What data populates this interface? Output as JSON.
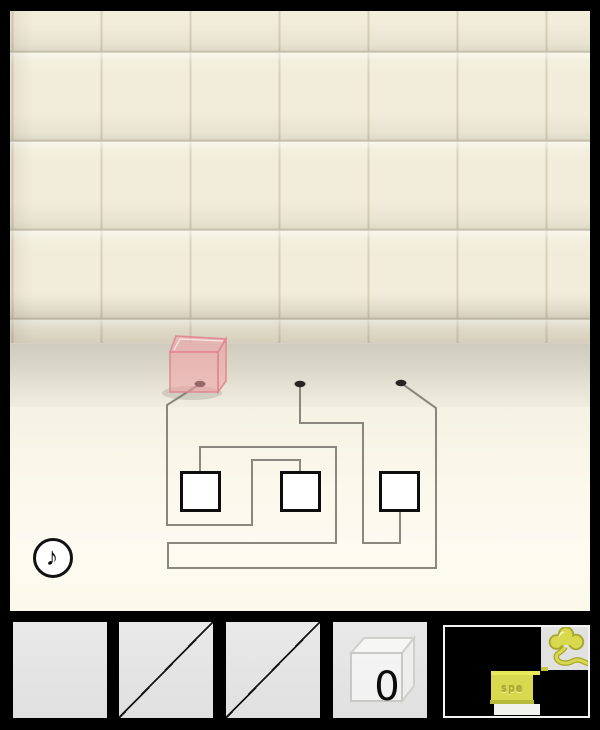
{
  "theme": {
    "tile": "#f2edda",
    "grout": "#d7d0b9",
    "ct-back": "#cfcbbd",
    "ct-front": "#f1eee1",
    "face1": "#f7f4e6",
    "face2": "#fdfbf1",
    "gold": "#d9d94f",
    "gold-bright": "#e9e95e",
    "gold-dark": "#b9b93c"
  },
  "scene": {
    "music_button": {
      "glyph": "♪"
    },
    "pink_cube": {
      "fill": "#f2a0a6",
      "edge": "#e2848f",
      "opacity": 0.55,
      "front": [
        [
          160,
          341
        ],
        [
          208,
          341
        ],
        [
          208,
          381
        ],
        [
          160,
          381
        ]
      ],
      "top": [
        [
          160,
          341
        ],
        [
          166,
          325
        ],
        [
          216,
          328
        ],
        [
          208,
          341
        ]
      ],
      "side": [
        [
          208,
          341
        ],
        [
          216,
          328
        ],
        [
          216,
          370
        ],
        [
          208,
          381
        ]
      ],
      "shadow": [
        182,
        382,
        30,
        7
      ]
    },
    "wire_puzzle": {
      "wire_color": "#8a877e",
      "dot_color": "#2a2420",
      "dots": [
        [
          190,
          373
        ],
        [
          290,
          373
        ],
        [
          391,
          372
        ]
      ],
      "boxes": [
        [
          170,
          460,
          41,
          41
        ],
        [
          270,
          460,
          41,
          41
        ],
        [
          369,
          460,
          41,
          41
        ]
      ],
      "paths": [
        [
          [
            190,
            373
          ],
          [
            157,
            394
          ],
          [
            157,
            514
          ],
          [
            242,
            514
          ],
          [
            242,
            449
          ],
          [
            290,
            449
          ],
          [
            290,
            462
          ]
        ],
        [
          [
            290,
            373
          ],
          [
            290,
            412
          ],
          [
            353,
            412
          ],
          [
            353,
            532
          ],
          [
            390,
            532
          ],
          [
            390,
            500
          ]
        ],
        [
          [
            391,
            372
          ],
          [
            426,
            397
          ],
          [
            426,
            557
          ],
          [
            158,
            557
          ],
          [
            158,
            532
          ],
          [
            326,
            532
          ],
          [
            326,
            436
          ],
          [
            190,
            436
          ],
          [
            190,
            462
          ]
        ]
      ]
    }
  },
  "inventory": {
    "slots": [
      {
        "id": 1,
        "state": "empty"
      },
      {
        "id": 2,
        "state": "used"
      },
      {
        "id": 3,
        "state": "used"
      },
      {
        "id": 4,
        "state": "glass-cube",
        "count": "0"
      },
      {
        "id": 5,
        "state": "selected-gold-plate",
        "text": "spe"
      },
      {
        "id": 6,
        "state": "gold-flower-item"
      }
    ]
  }
}
